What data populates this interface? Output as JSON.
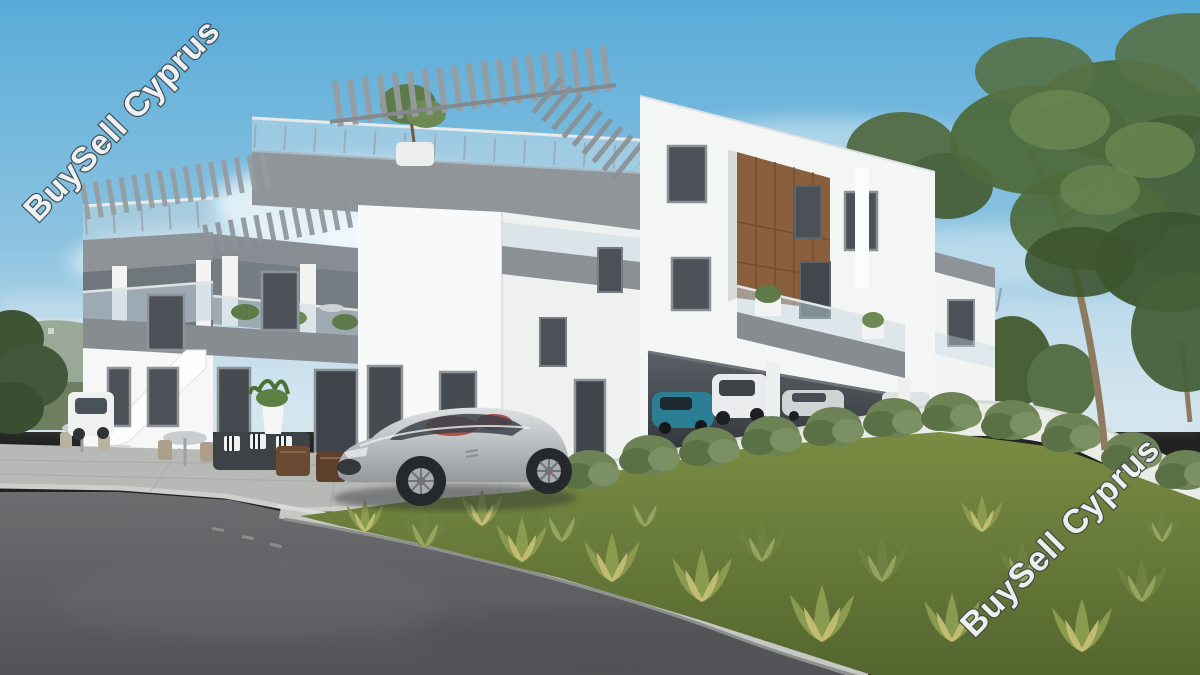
{
  "image": {
    "kind": "real-estate-3d-render",
    "description": "3D architectural rendering of a modern white two/three-storey apartment building with grey rooftop pergolas, glass balustrade terraces, a timber accent facade, covered parking with cars, a silver sports car parked out front, paved patio with outdoor furniture, asphalt road and a landscaped garden with ornamental grasses and tall trees under a hazy blue sky"
  },
  "watermarks": {
    "top_left": {
      "text": "BuySell Cyprus",
      "rotation_deg": -46
    },
    "bottom_right": {
      "text": "BuySell Cyprus",
      "rotation_deg": -45
    }
  },
  "palette": {
    "sky_blue": "#58abd8",
    "cloud_white": "#f2f7fa",
    "building_white": "#f8f9f8",
    "fascia_gray": "#878d92",
    "pergola_gray": "#969ca0",
    "glass_balustrade": "#c3d6e0",
    "window_glass": "#4b5157",
    "wood_accent": "#8a5f3d",
    "asphalt_gray": "#5e6062",
    "paving_gray": "#b7b9b6",
    "curb_gray": "#c6c8c5",
    "lawn_green": "#6f7f3e",
    "grass_tuft_yellow": "#c9c178",
    "shrub_green": "#6d8355",
    "tree_green": "#4e6a3c",
    "sports_car_silver": "#b9bdc0",
    "sports_car_interior_red": "#b0453e",
    "parked_car_teal": "#2c7e95"
  }
}
